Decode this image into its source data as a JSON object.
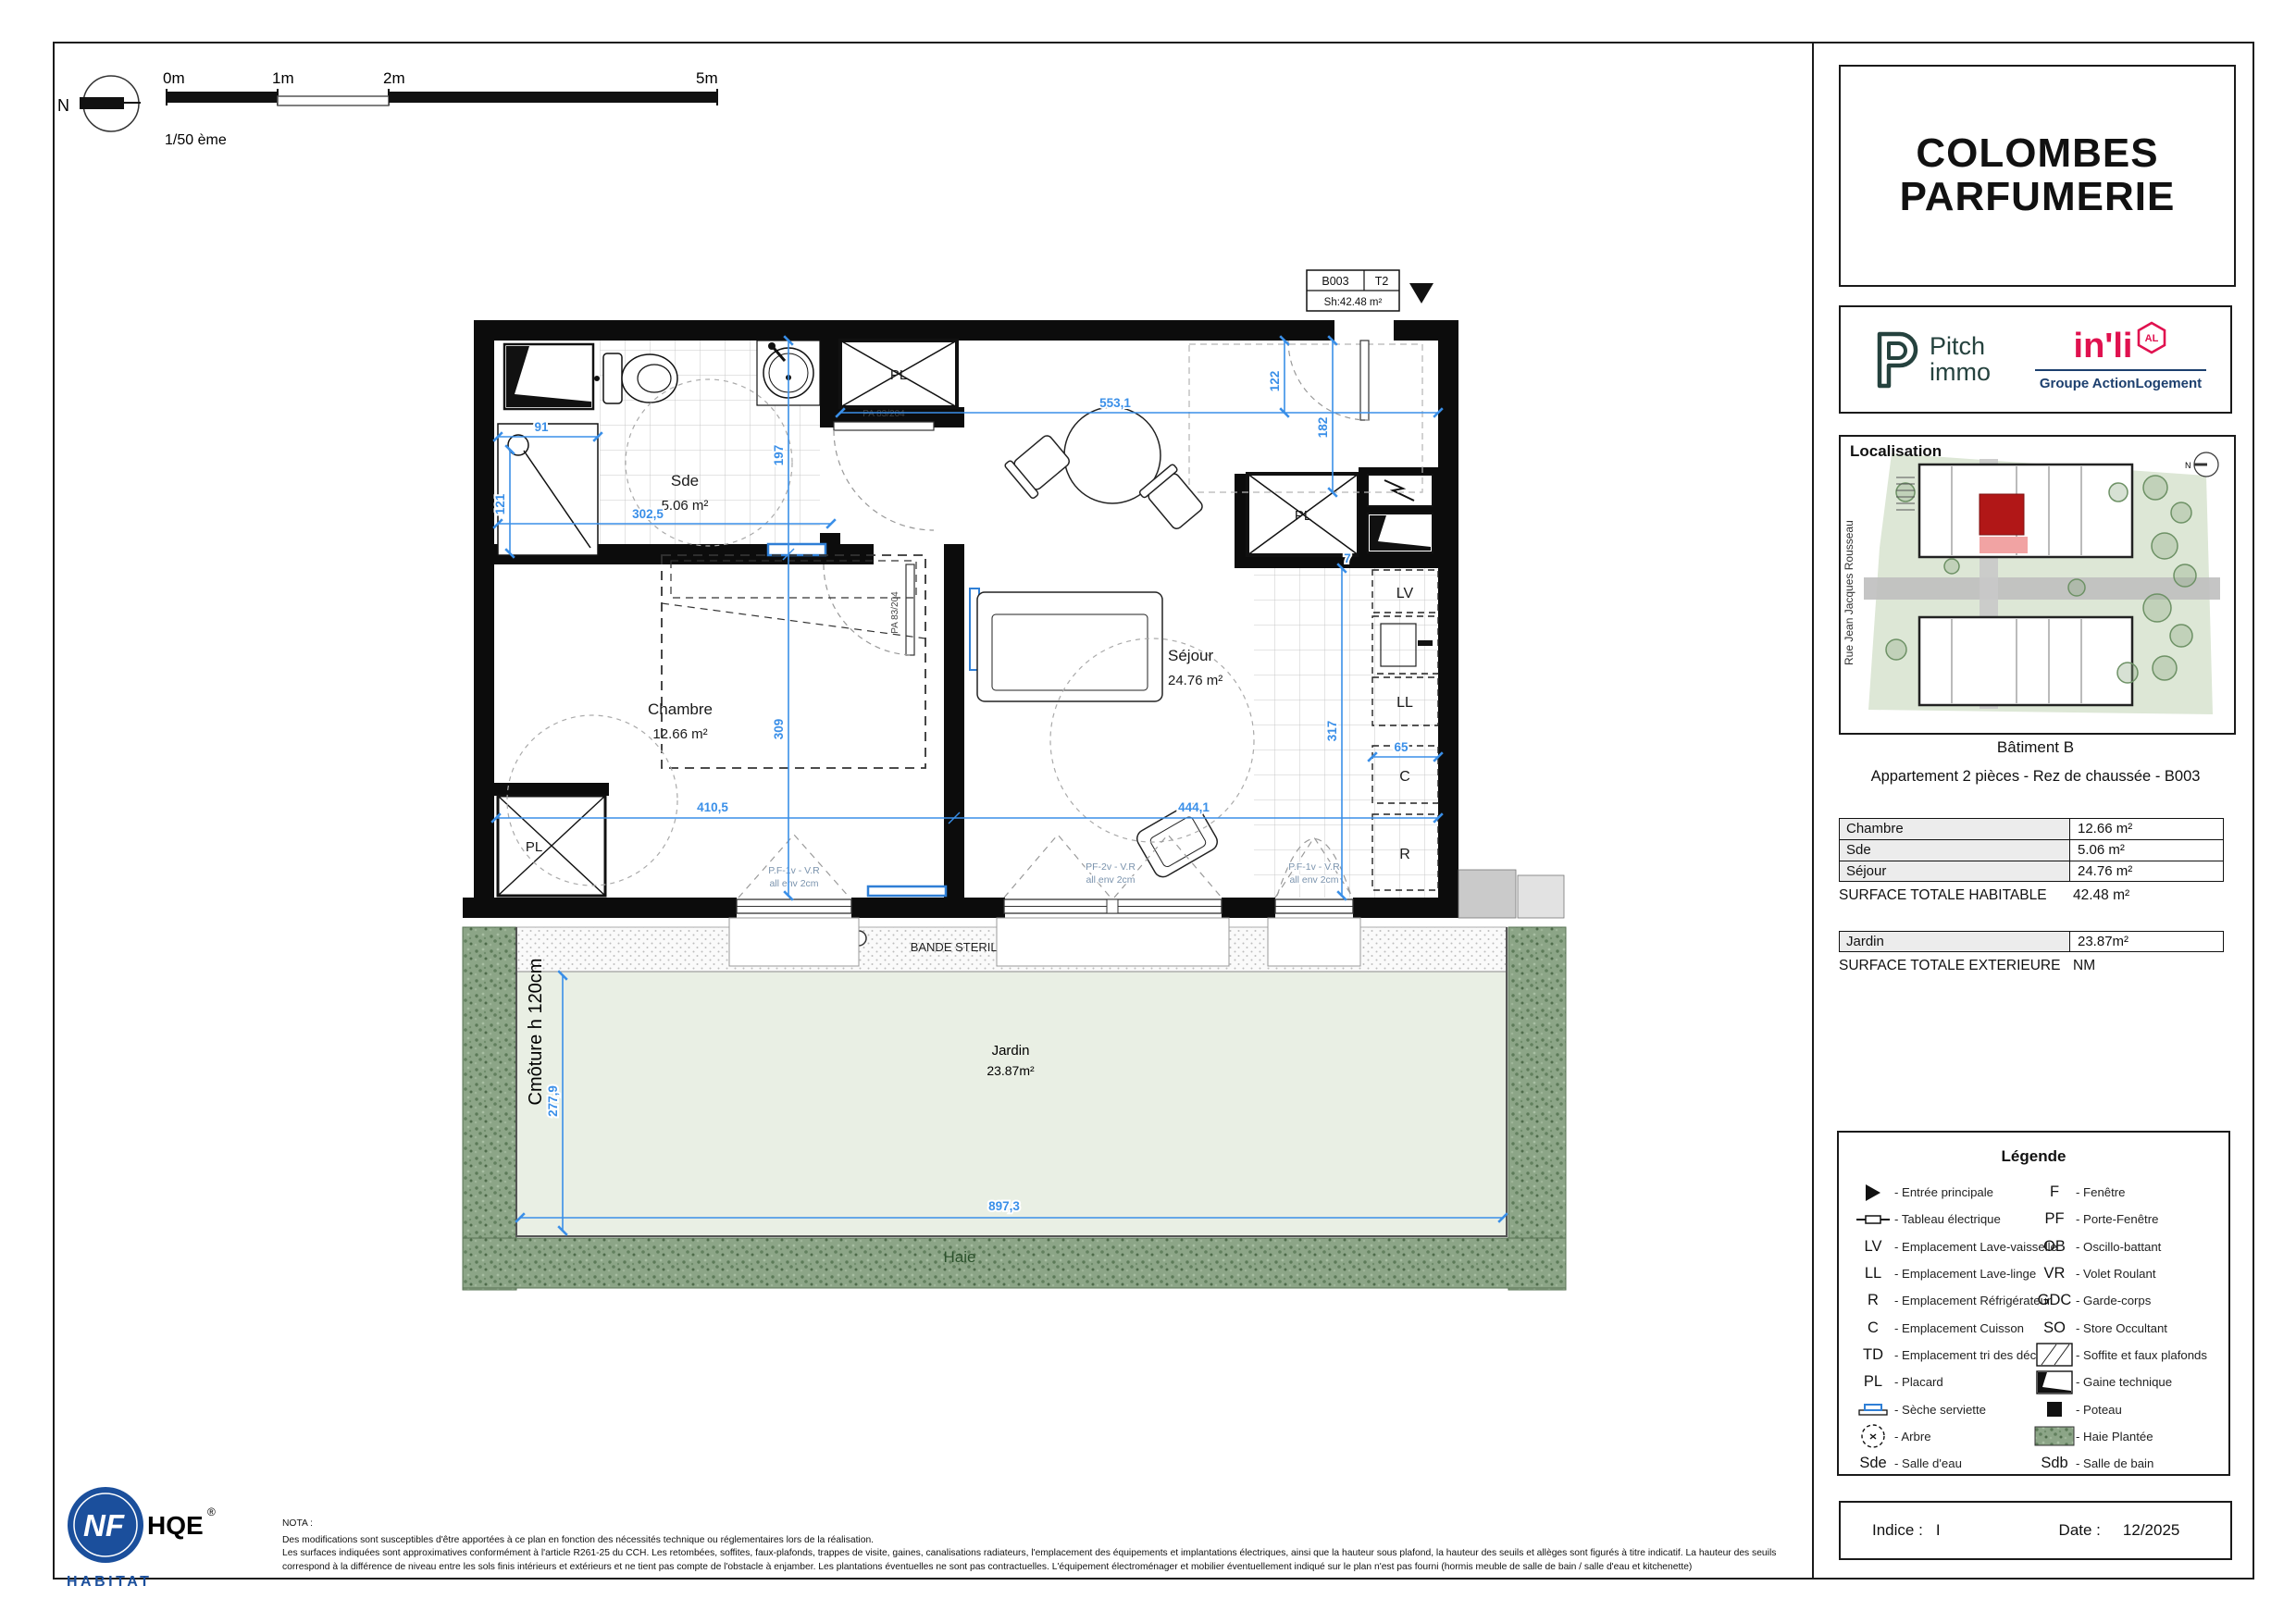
{
  "scale_bar": {
    "m0": "0m",
    "m1": "1m",
    "m2": "2m",
    "m5": "5m",
    "ratio": "1/50 ème",
    "north": "N"
  },
  "unit_tag": {
    "code": "B003",
    "type": "T2",
    "surface": "Sh:42.48 m²"
  },
  "plan": {
    "rooms": {
      "sde_name": "Sde",
      "sde_area": "5.06 m²",
      "chambre_name": "Chambre",
      "chambre_area": "12.66 m²",
      "sejour_name": "Séjour",
      "sejour_area": "24.76 m²",
      "jardin_name": "Jardin",
      "jardin_area": "23.87m²"
    },
    "labels": {
      "pl_hall": "PL",
      "pl_entry": "PL",
      "pl_chambre": "PL",
      "lv": "LV",
      "ll": "LL",
      "c": "C",
      "r": "R",
      "door_sde": "PA 83/204",
      "door_chambre": "PA 83/204",
      "bande_sterile": "BANDE STERILE",
      "haie": "Haie",
      "cloture": "Cmôture h 120cm"
    },
    "windows": {
      "w1a": "P.F-1v - V.R",
      "w1b": "all env 2cm",
      "w2a": "PF-2v - V.R",
      "w2b": "all env 2cm",
      "w3a": "P.F-1v - V.R",
      "w3b": "all env 2cm"
    },
    "dims": {
      "d91": "91",
      "d121": "121",
      "d302": "302,5",
      "d197": "197",
      "d553": "553,1",
      "d122": "122",
      "d182": "182",
      "d309": "309",
      "d410": "410,5",
      "d444": "444,1",
      "d317": "317",
      "d65": "65",
      "d7": "7",
      "d277": "277,9",
      "d897": "897,3"
    }
  },
  "sidebar": {
    "title_line1": "COLOMBES",
    "title_line2": "PARFUMERIE",
    "logos": {
      "pitch_line1": "Pitch",
      "pitch_line2": "immo",
      "inli": "in'li",
      "inli_badge": "AL",
      "inli_sub": "Groupe ActionLogement"
    },
    "localisation": {
      "label": "Localisation",
      "street": "Rue Jean Jacques Rousseau",
      "north": "N"
    },
    "building": "Bâtiment B",
    "apartment": "Appartement 2 pièces - Rez de chaussée - B003",
    "surface_table": {
      "rows": [
        {
          "label": "Chambre",
          "value": "12.66 m²"
        },
        {
          "label": "Sde",
          "value": "5.06 m²"
        },
        {
          "label": "Séjour",
          "value": "24.76 m²"
        }
      ],
      "total_label": "SURFACE TOTALE HABITABLE",
      "total_value": "42.48  m²",
      "ext_rows": [
        {
          "label": "Jardin",
          "value": "23.87m²"
        }
      ],
      "ext_label": "SURFACE TOTALE EXTERIEURE",
      "ext_value": "NM"
    },
    "legend": {
      "title": "Légende",
      "left": [
        {
          "symbol": "",
          "label": "- Entrée principale"
        },
        {
          "symbol": "",
          "label": "- Tableau électrique"
        },
        {
          "symbol": "LV",
          "label": "- Emplacement Lave-vaisselle"
        },
        {
          "symbol": "LL",
          "label": "- Emplacement Lave-linge"
        },
        {
          "symbol": "R",
          "label": "- Emplacement Réfrigérateur"
        },
        {
          "symbol": "C",
          "label": "- Emplacement Cuisson"
        },
        {
          "symbol": "TD",
          "label": "- Emplacement tri des déchêts"
        },
        {
          "symbol": "PL",
          "label": "- Placard"
        },
        {
          "symbol": "",
          "label": "- Sèche serviette"
        },
        {
          "symbol": "",
          "label": "- Arbre"
        },
        {
          "symbol": "Sde",
          "label": "- Salle d'eau"
        }
      ],
      "right": [
        {
          "symbol": "F",
          "label": "- Fenêtre"
        },
        {
          "symbol": "PF",
          "label": "- Porte-Fenêtre"
        },
        {
          "symbol": "OB",
          "label": "- Oscillo-battant"
        },
        {
          "symbol": "VR",
          "label": "- Volet Roulant"
        },
        {
          "symbol": "GDC",
          "label": "- Garde-corps"
        },
        {
          "symbol": "SO",
          "label": "- Store Occultant"
        },
        {
          "symbol": "",
          "label": "- Soffite et faux plafonds"
        },
        {
          "symbol": "",
          "label": "- Gaine technique"
        },
        {
          "symbol": "",
          "label": "- Poteau"
        },
        {
          "symbol": "",
          "label": "- Haie Plantée"
        },
        {
          "symbol": "Sdb",
          "label": "- Salle de bain"
        }
      ]
    },
    "footer": {
      "indice_label": "Indice :",
      "indice_value": "I",
      "date_label": "Date :",
      "date_value": "12/2025"
    }
  },
  "cert": {
    "nf": "NF",
    "hqe": "HQE",
    "reg": "®",
    "habitat": "HABITAT"
  },
  "nota": {
    "title": "NOTA :",
    "line1": "Des modifications sont susceptibles d'être apportées à ce plan en fonction des nécessités technique ou réglementaires lors de la réalisation.",
    "line2": "Les surfaces indiquées sont approximatives conformément à l'article R261-25 du CCH. Les retombées, soffites, faux-plafonds, trappes de visite, gaines, canalisations radiateurs, l'emplacement des équipements et implantations électriques, ainsi que la hauteur sous plafond, la hauteur des seuils et allèges sont figurés à titre indicatif. La hauteur des seuils",
    "line3": "correspond à la différence de niveau entre les sols finis intérieurs et extérieurs et ne tient pas compte de l'obstacle à enjamber. Les plantations éventuelles ne sont pas contractuelles. L'équipement électroménager et mobilier éventuellement indiqué sur le plan n'est pas fourni (hormis meuble de salle de bain / salle d'eau et kitchenette)"
  },
  "colors": {
    "dim_blue": "#3a8fe8",
    "hedge_green": "#8ca587",
    "garden_green": "#e9efe4",
    "unit_red": "#b11717",
    "inli_pink": "#e0114f",
    "navy": "#1c3f6e",
    "nf_blue": "#1b4f9c"
  }
}
